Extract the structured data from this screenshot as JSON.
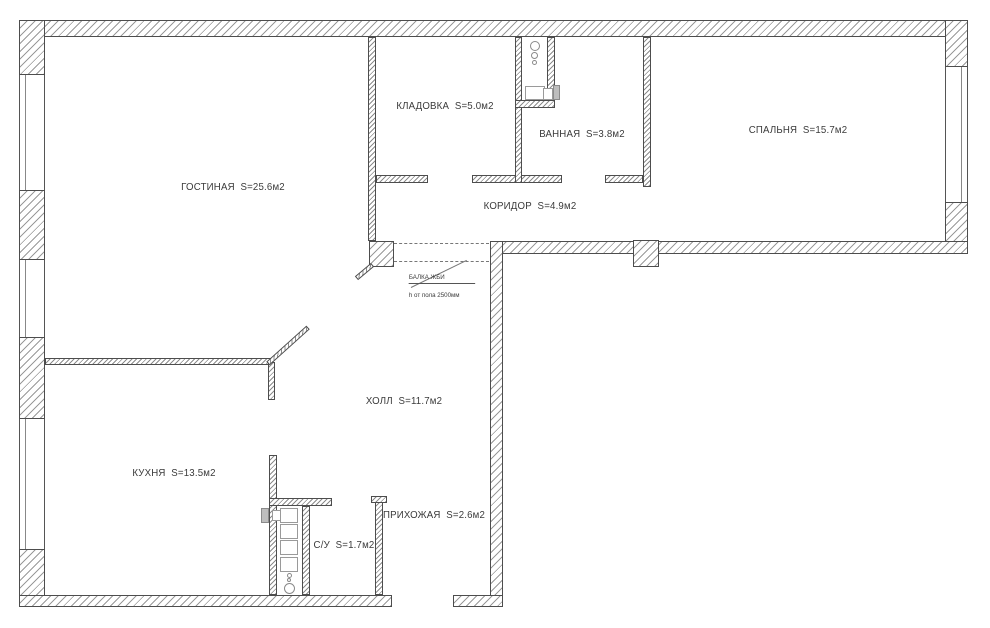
{
  "plan_title": "apartment-floor-plan",
  "rooms": {
    "living": {
      "label": "ГОСТИНАЯ  S=25.6м2"
    },
    "storage": {
      "label": "КЛАДОВКА  S=5.0м2"
    },
    "bathroom": {
      "label": "ВАННАЯ  S=3.8м2"
    },
    "bedroom": {
      "label": "СПАЛЬНЯ  S=15.7м2"
    },
    "corridor": {
      "label": "КОРИДОР  S=4.9м2"
    },
    "hall": {
      "label": "ХОЛЛ  S=11.7м2"
    },
    "kitchen": {
      "label": "КУХНЯ  S=13.5м2"
    },
    "wc": {
      "label": "С/У  S=1.7м2"
    },
    "entry": {
      "label": "ПРИХОЖАЯ  S=2.6м2"
    }
  },
  "beam_note": {
    "line1": "БАЛКА ЖБИ",
    "line2": "h от пола 2500мм"
  },
  "colors": {
    "wall_border": "#4d4d4d",
    "hatch": "#9a9a9a",
    "text": "#3a3a3a"
  }
}
